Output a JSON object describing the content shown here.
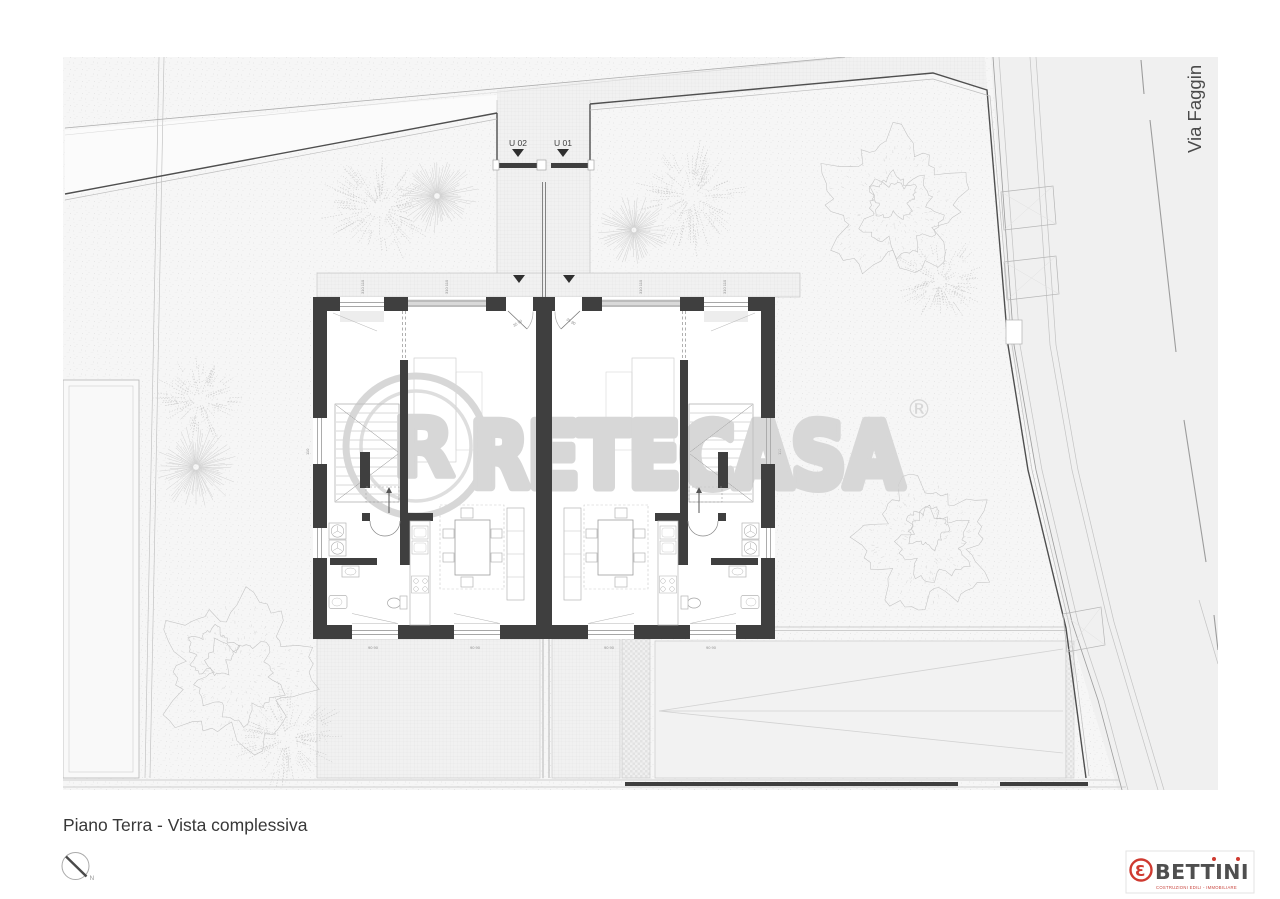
{
  "title_block": {
    "title": "Piano Terra - Vista complessiva",
    "north_label": "N"
  },
  "street": {
    "name": "Via Faggin"
  },
  "gate": {
    "unit_left": "U 02",
    "unit_right": "U 01"
  },
  "watermark": {
    "brand": "RETECASA",
    "registered": "®",
    "logo_letter": "R"
  },
  "publisher": {
    "name": "BETTINI",
    "tagline": "COSTRUZIONI EDILI  -  IMMOBILIARE",
    "icon_glyph": "Ɛ"
  },
  "dimensions": {
    "top_window": "310 110",
    "bottom_window": "90  90",
    "side_window": "110",
    "entrance": "35 90"
  },
  "colors": {
    "wall": "#3f3f3f",
    "accent_red": "#cf3a30",
    "watermark_gray": "#d7d7d7",
    "drawing_line": "#9c9c9c",
    "paper": "#ffffff"
  }
}
